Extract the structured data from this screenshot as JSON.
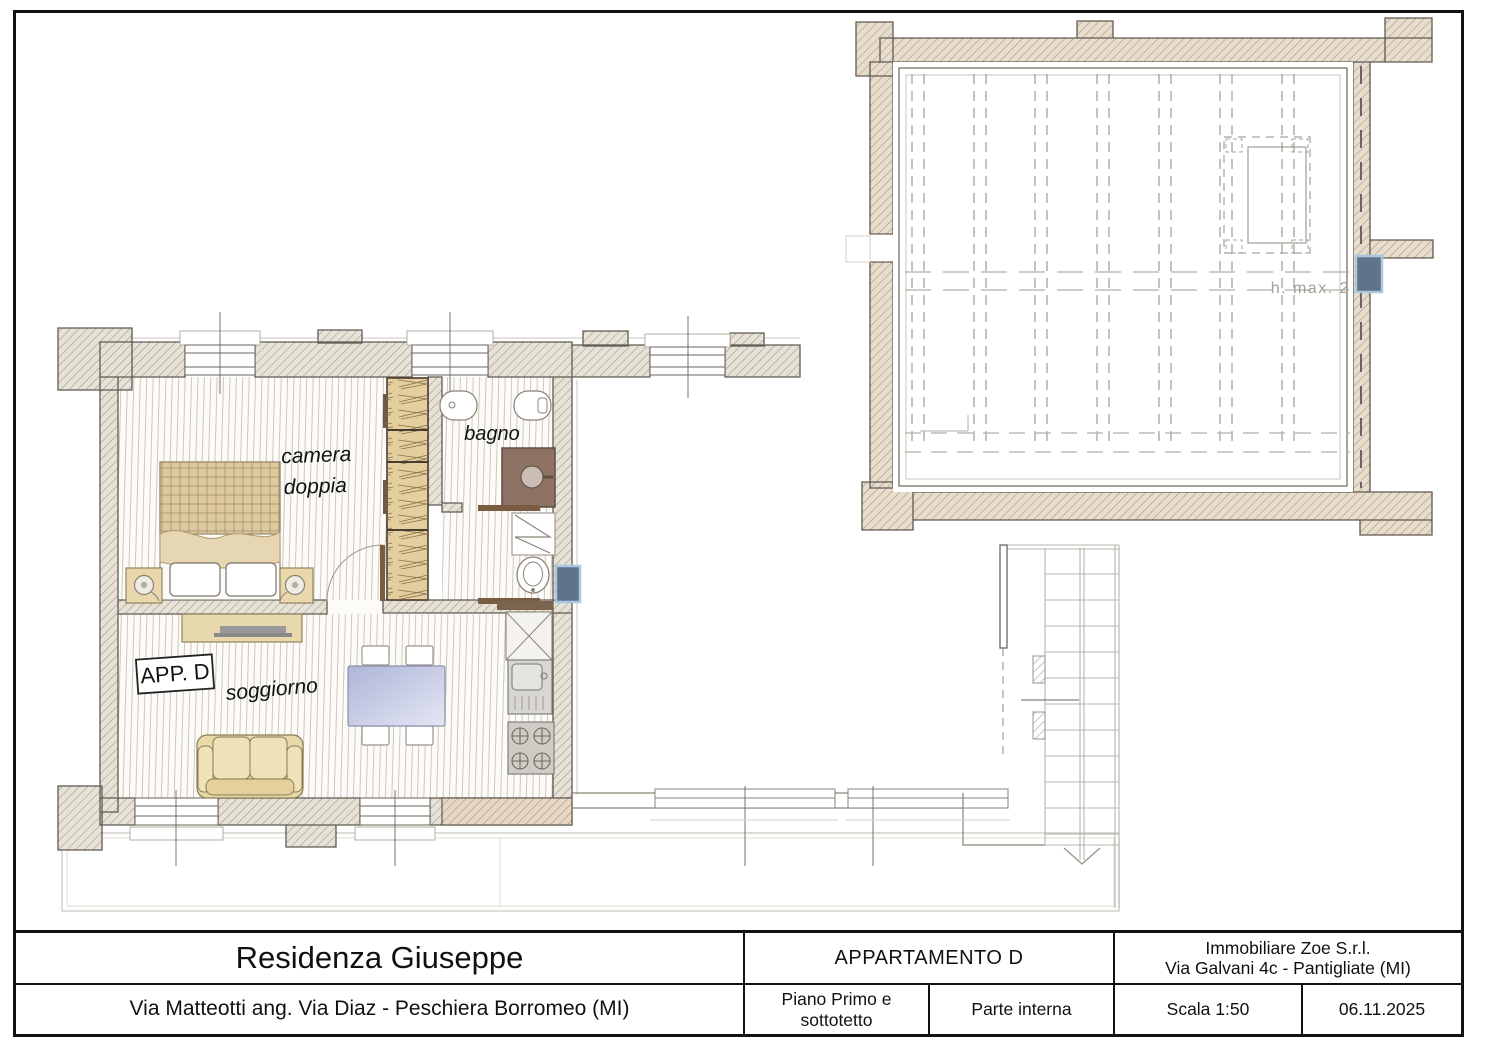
{
  "plan": {
    "apartment_tag": "APP. D",
    "labels": {
      "bedroom_line1": "camera",
      "bedroom_line2": "doppia",
      "bathroom": "bagno",
      "living_room": "soggiorno",
      "attic_height_note": "h. max. 2"
    },
    "colors": {
      "wall_fill": "#e6e2d7",
      "wall_fill_warm": "#e8dccd",
      "wall_outline": "#5f5a52",
      "hatch_line": "#a3947f",
      "floor_line": "#c8c2b6",
      "furniture_tan": "#e9d8ab",
      "shower_brown": "#8d7263",
      "table_blue": "#c5cbe3",
      "radiator_blue": "#5f7389",
      "stair_gray": "#b9b5ad"
    }
  },
  "title_block": {
    "project_name": "Residenza Giuseppe",
    "project_address": "Via Matteotti ang. Via Diaz - Peschiera Borromeo (MI)",
    "apartment_title": "APPARTAMENTO D",
    "floor_label": "Piano Primo e sottotetto",
    "scope_label": "Parte interna",
    "company_line1": "Immobiliare Zoe S.r.l.",
    "company_line2": "Via Galvani 4c - Pantigliate (MI)",
    "scale_label": "Scala 1:50",
    "date_label": "06.11.2025"
  }
}
